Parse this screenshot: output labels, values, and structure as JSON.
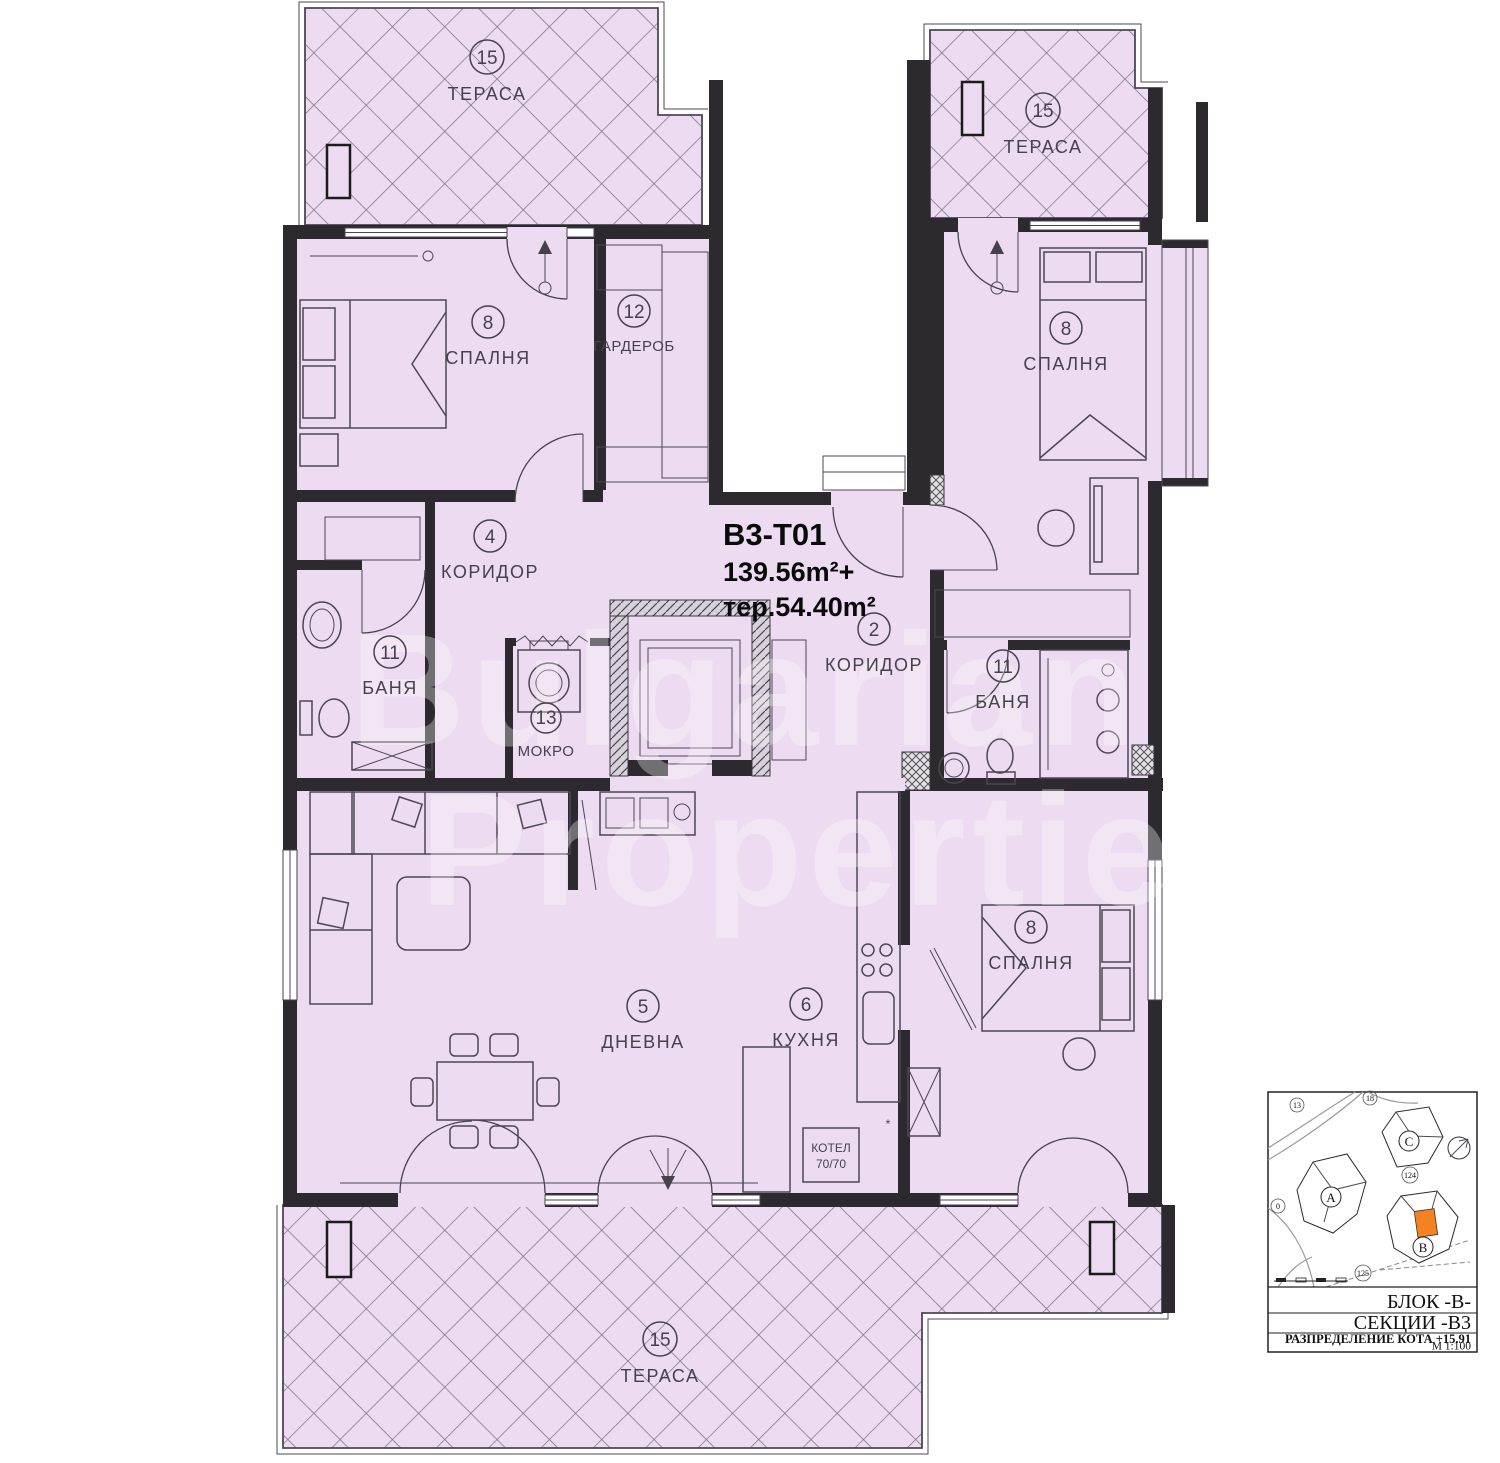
{
  "plan": {
    "unit_code": "B3-T01",
    "area_line": "139.56m²+",
    "terrace_area_line": "тер.54.40m²",
    "rooms": {
      "terrace_tl": {
        "number": "15",
        "name": "ТЕРАСА"
      },
      "terrace_tr": {
        "number": "15",
        "name": "ТЕРАСА"
      },
      "terrace_bottom": {
        "number": "15",
        "name": "ТЕРАСА"
      },
      "bedroom_tl": {
        "number": "8",
        "name": "СПАЛНЯ"
      },
      "wardrobe": {
        "number": "12",
        "name": "ГАРДЕРОБ"
      },
      "corridor_4": {
        "number": "4",
        "name": "КОРИДОР"
      },
      "bath_left": {
        "number": "11",
        "name": "БАНЯ"
      },
      "mokro": {
        "number": "13",
        "name": "МОКРО"
      },
      "corridor_2": {
        "number": "2",
        "name": "КОРИДОР"
      },
      "bedroom_tr": {
        "number": "8",
        "name": "СПАЛНЯ"
      },
      "bath_right": {
        "number": "11",
        "name": "БАНЯ"
      },
      "living": {
        "number": "5",
        "name": "ДНЕВНА"
      },
      "kitchen": {
        "number": "6",
        "name": "КУХНЯ"
      },
      "bedroom_br": {
        "number": "8",
        "name": "СПАЛНЯ"
      }
    },
    "boiler": {
      "line1": "КОТЕЛ",
      "line2": "70/70"
    },
    "kitchen_star": "*"
  },
  "sitemap": {
    "buildings": {
      "a": "А",
      "b": "В",
      "c": "С"
    },
    "plots": {
      "p13": "13",
      "p18": "18",
      "p124": "124",
      "p125": "125",
      "p0": "0"
    },
    "footer": {
      "block": "БЛОК -В-",
      "section": "СЕКЦИИ -В3",
      "level": "РАЗПРЕДЕЛЕНИЕ  КОТА +15.91",
      "scale": "М 1:100"
    },
    "highlight_color": "#f58220"
  },
  "watermark": {
    "line1": "Bulgarian",
    "line2": "Properties"
  },
  "colors": {
    "floor": "#ecdbf1",
    "wall": "#2c2a2e",
    "accent_orange": "#f58220"
  }
}
